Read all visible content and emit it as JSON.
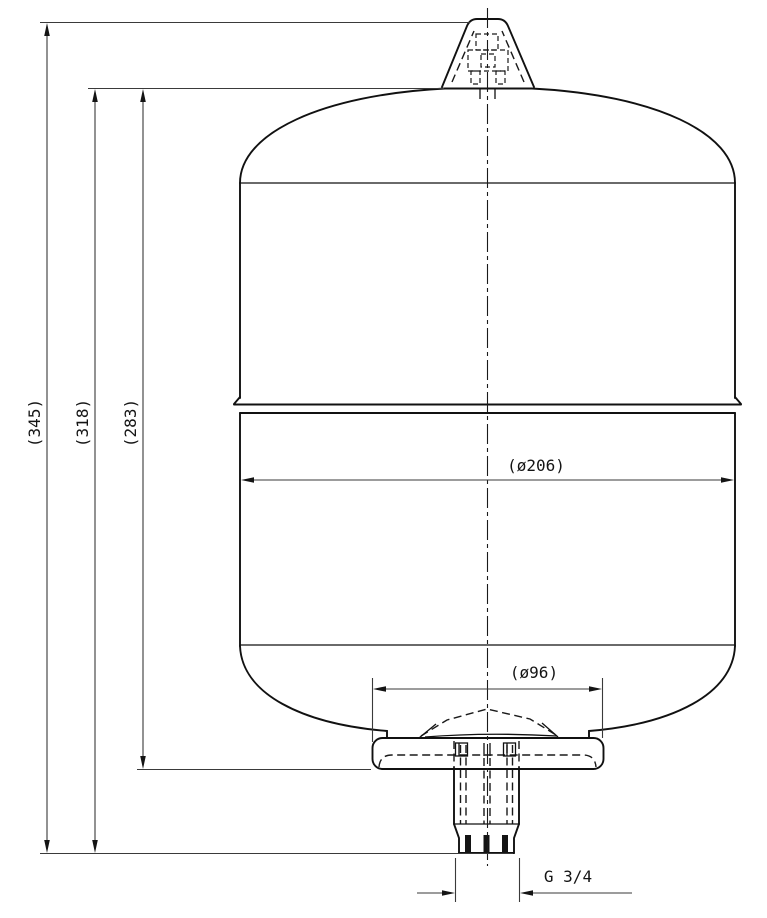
{
  "page": {
    "background": "#ffffff"
  },
  "drawing": {
    "kind": "technical dimension drawing",
    "subject": "vertical expansion vessel with top air valve and bottom G 3/4 threaded connection, front elevation",
    "line_color": "#141414",
    "labels": {
      "dim_overall_height": "(345)",
      "dim_height_no_valve": "(318)",
      "dim_body_height": "(283)",
      "dim_outer_diameter": "(ø206)",
      "dim_base_diameter": "(ø96)",
      "dim_thread": "G 3/4"
    }
  }
}
